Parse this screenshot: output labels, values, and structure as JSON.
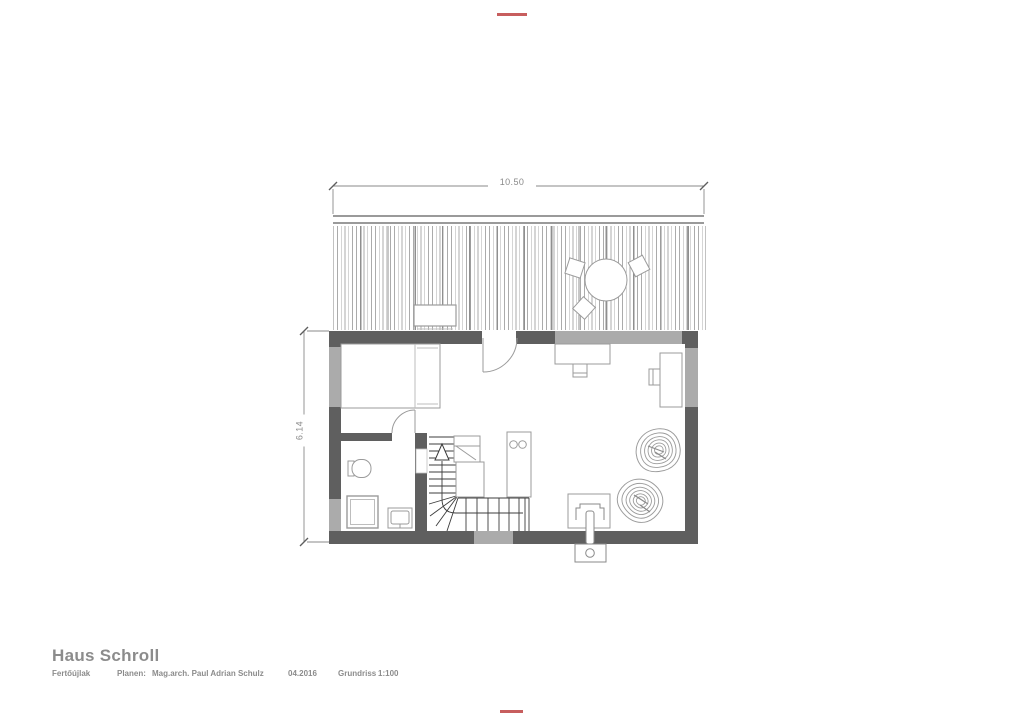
{
  "title_block": {
    "project": "Haus Schroll",
    "location": "Fertőújlak",
    "planner_label": "Planen:",
    "planner_name": "Mag.arch. Paul Adrian Schulz",
    "date": "04.2016",
    "drawing_type": "Grundriss",
    "scale": "1:100"
  },
  "dimensions": {
    "width": "10.50",
    "height": "6.14"
  },
  "colors": {
    "wall_dark": "#5f5f5f",
    "wall_light": "#ababab",
    "line_gray": "#9b9b9b",
    "dim_gray": "#8a8a8a",
    "stair_dark": "#3c3c3c",
    "title_gray": "#8c8c8c",
    "mark_red": "#bd4242",
    "deck_hatch": "#ababab",
    "deck_edge": "#9a9a9a"
  }
}
